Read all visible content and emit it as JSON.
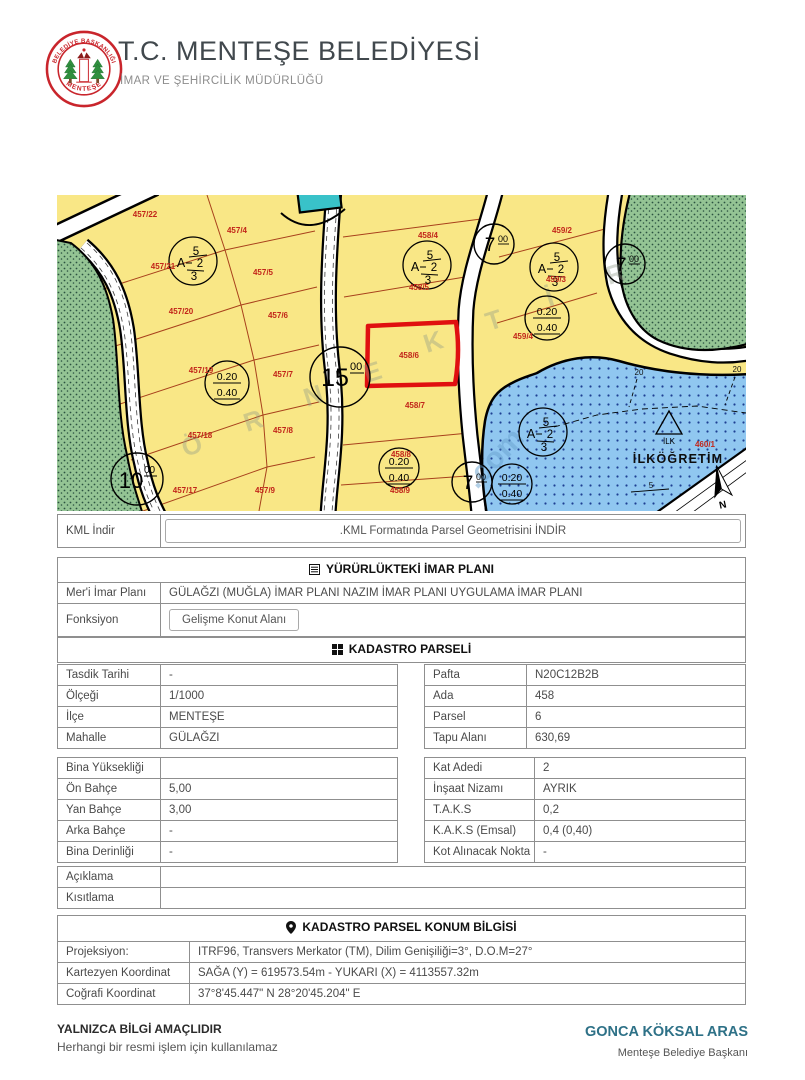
{
  "header": {
    "title": "T.C. MENTEŞE BELEDİYESİ",
    "subtitle": "İMAR VE ŞEHİRCİLİK MÜDÜRLÜĞÜ",
    "logo_top": "BELEDİYE BAŞKANLIĞI",
    "logo_bottom": "MENTEŞE"
  },
  "map": {
    "parcel_labels": [
      "457/22",
      "457/4",
      "457/21",
      "457/5",
      "457/20",
      "457/6",
      "457/19",
      "457/7",
      "457/18",
      "457/8",
      "457/17",
      "457/9",
      "458/4",
      "458/5",
      "458/6",
      "458/7",
      "458/8",
      "458/9",
      "459/2",
      "459/3",
      "459/4",
      "460/1"
    ],
    "zoning_symbol": {
      "top": "5",
      "letter": "A",
      "mid": "2",
      "bottom": "3"
    },
    "ratio_symbol": {
      "top": "0.20",
      "bottom": "0.40"
    },
    "road_widths": [
      {
        "v": "15",
        "sup": "00"
      },
      {
        "v": "7",
        "sup": "00"
      },
      {
        "v": "7",
        "sup": "00"
      },
      {
        "v": "7",
        "sup": "00"
      },
      {
        "v": "10",
        "sup": "00"
      }
    ],
    "school_name": "İLKÖĞRETİM",
    "school_symbol": "İLK",
    "north_label": "N",
    "dim_labels": [
      "20",
      "20",
      "5"
    ],
    "watermark_letters": [
      "Ö",
      "R",
      "N",
      "E",
      "K",
      "T",
      "İ",
      "R"
    ],
    "watermark_com": ".com",
    "highlight_color": "#e01010"
  },
  "kml": {
    "label": "KML İndir",
    "button": ".KML Formatında Parsel Geometrisini İNDİR"
  },
  "plan": {
    "header": "YÜRÜRLÜKTEKİ İMAR PLANI",
    "meri_label": "Mer'i İmar Planı",
    "meri_value": "GÜLAĞZI (MUĞLA) İMAR PLANI NAZIM İMAR PLANI UYGULAMA İMAR PLANI",
    "fonksiyon_label": "Fonksiyon",
    "fonksiyon_value": "Gelişme Konut Alanı"
  },
  "kadastro": {
    "header": "KADASTRO PARSELİ",
    "info_left": [
      {
        "label": "Tasdik Tarihi",
        "value": "-"
      },
      {
        "label": "Ölçeği",
        "value": "1/1000"
      },
      {
        "label": "İlçe",
        "value": "MENTEŞE"
      },
      {
        "label": "Mahalle",
        "value": "GÜLAĞZI"
      }
    ],
    "info_right": [
      {
        "label": "Pafta",
        "value": "N20C12B2B"
      },
      {
        "label": "Ada",
        "value": "458"
      },
      {
        "label": "Parsel",
        "value": "6"
      },
      {
        "label": "Tapu Alanı",
        "value": "630,69"
      }
    ],
    "zoning_left": [
      {
        "label": "Bina Yüksekliği",
        "value": ""
      },
      {
        "label": "Ön Bahçe",
        "value": "5,00"
      },
      {
        "label": "Yan Bahçe",
        "value": "3,00"
      },
      {
        "label": "Arka Bahçe",
        "value": "-"
      },
      {
        "label": "Bina Derinliği",
        "value": "-"
      }
    ],
    "zoning_right": [
      {
        "label": "Kat Adedi",
        "value": "2"
      },
      {
        "label": "İnşaat Nizamı",
        "value": "AYRIK"
      },
      {
        "label": "T.A.K.S",
        "value": "0,2"
      },
      {
        "label": "K.A.K.S (Emsal)",
        "value": "0,4 (0,40)"
      },
      {
        "label": "Kot Alınacak Nokta",
        "value": "-"
      }
    ],
    "notes": [
      {
        "label": "Açıklama",
        "value": ""
      },
      {
        "label": "Kısıtlama",
        "value": ""
      }
    ]
  },
  "konum": {
    "header": "KADASTRO PARSEL KONUM BİLGİSİ",
    "rows": [
      {
        "label": "Projeksiyon:",
        "value": "ITRF96, Transvers Merkator (TM), Dilim Genişiliği=3°, D.O.M=27°"
      },
      {
        "label": "Kartezyen Koordinat",
        "value": "SAĞA (Y) = 619573.54m - YUKARI (X) = 4113557.32m"
      },
      {
        "label": "Coğrafi Koordinat",
        "value": "37°8'45.447\" N 28°20'45.204\" E"
      }
    ]
  },
  "footer": {
    "disclaimer_title": "YALNIZCA BİLGİ AMAÇLIDIR",
    "disclaimer_text": "Herhangi bir resmi işlem için kullanılamaz",
    "mayor_name": "GONCA KÖKSAL ARAS",
    "mayor_title": "Menteşe Belediye Başkanı"
  }
}
